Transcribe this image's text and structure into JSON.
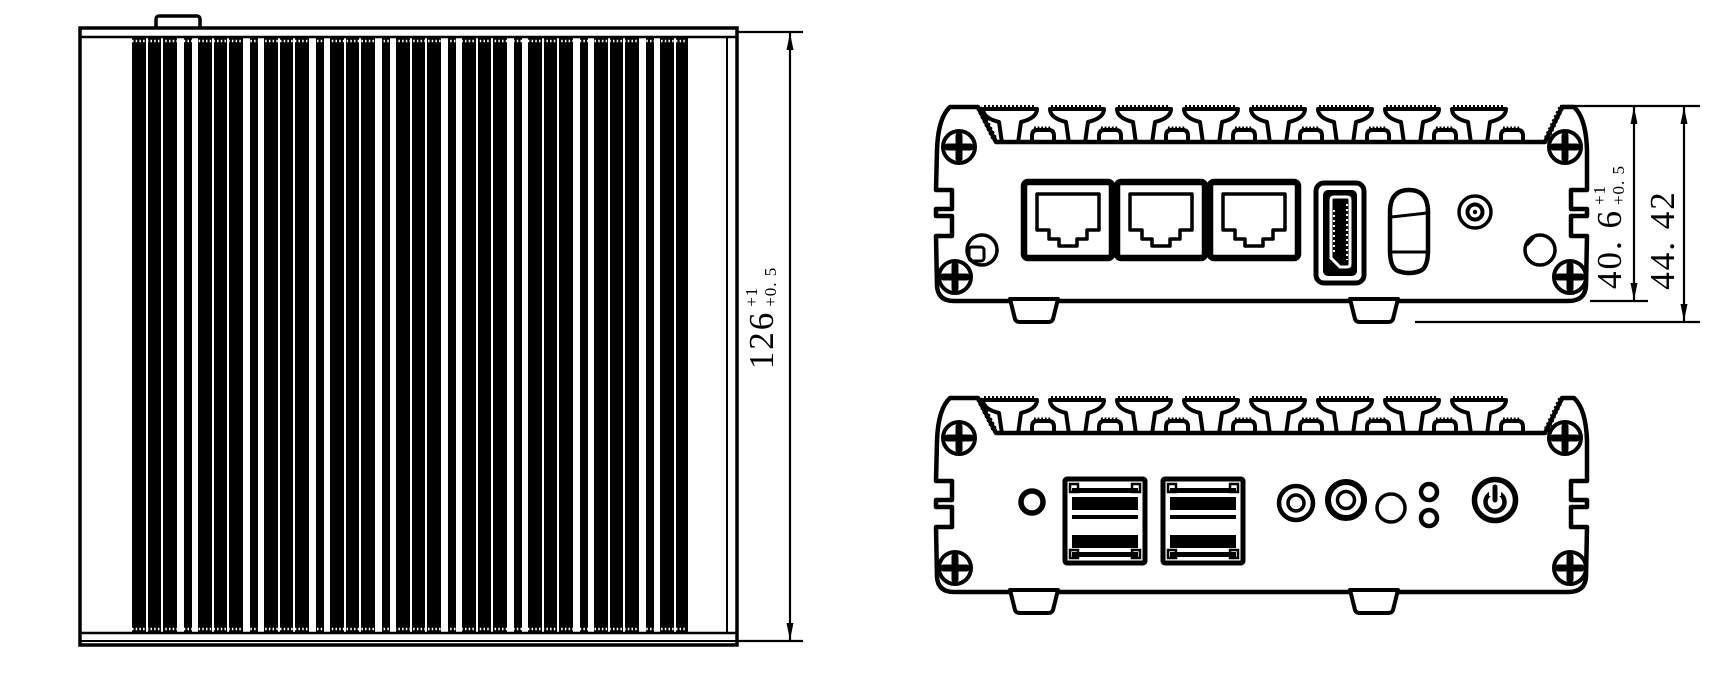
{
  "drawing": {
    "colors": {
      "line": "#000000",
      "background": "#ffffff"
    },
    "dimensions": {
      "heatsink_width": {
        "value": "126",
        "tol_upper": "+1",
        "tol_lower": "+0. 5"
      },
      "body_height": {
        "value": "40. 6",
        "tol_upper": "+1",
        "tol_lower": "+0. 5"
      },
      "overall_height": {
        "value": "44. 42"
      }
    },
    "views": {
      "top_view": {
        "name": "heatsink-top-view"
      },
      "rear_view": {
        "name": "rear-panel-view",
        "ports": [
          "rj45-port",
          "rj45-port",
          "rj45-port",
          "displayport-port",
          "vertical-port",
          "dc-jack"
        ]
      },
      "front_view": {
        "name": "front-panel-view",
        "ports": [
          "pinhole",
          "usb-port",
          "usb-port",
          "audio-jack",
          "audio-jack",
          "mic-hole",
          "led-indicator",
          "led-indicator",
          "power-button"
        ]
      }
    }
  }
}
